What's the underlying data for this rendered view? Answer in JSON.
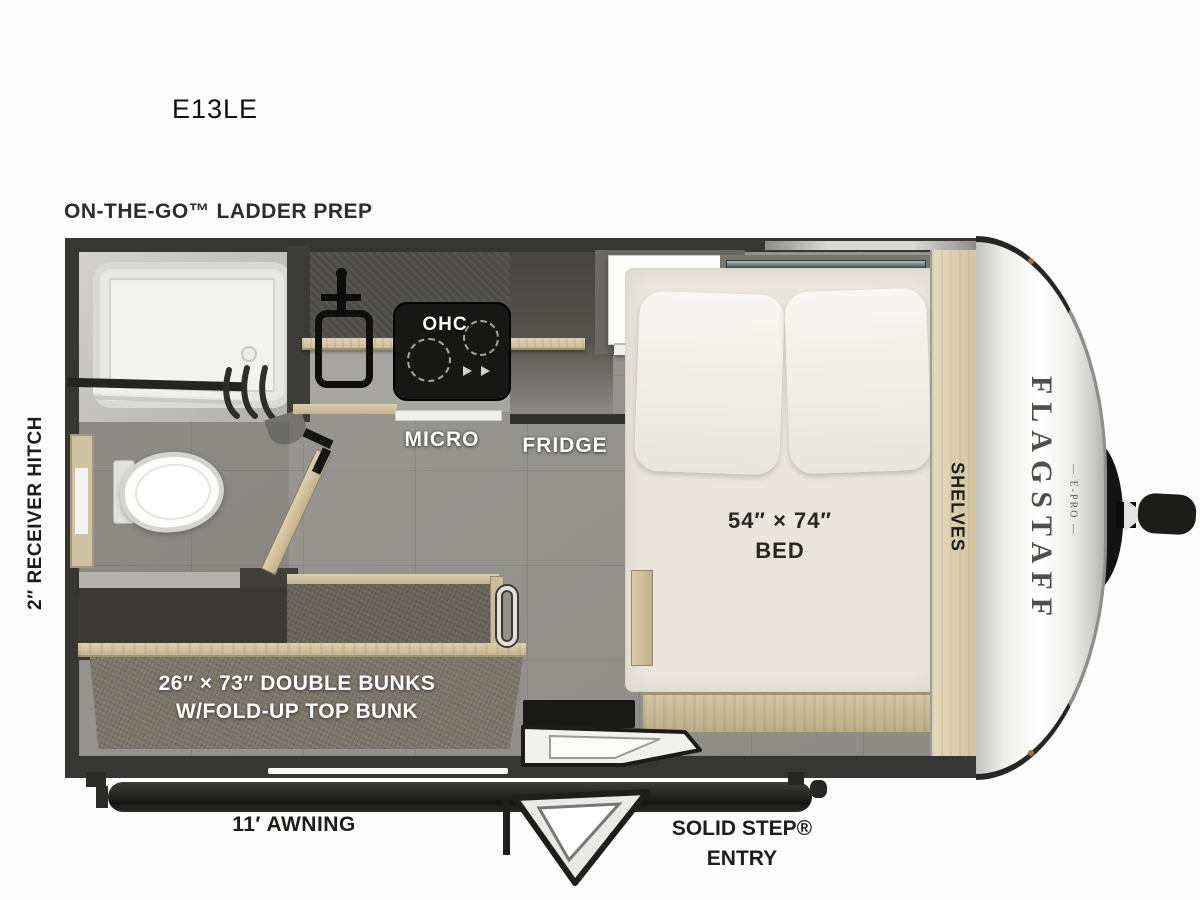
{
  "title": {
    "model": "E13LE"
  },
  "exterior_labels": {
    "ladder_prep": "ON-THE-GO™ LADDER PREP",
    "receiver_hitch": "2″ RECEIVER HITCH",
    "awning": "11′ AWNING",
    "solid_step": "SOLID STEP®",
    "entry": "ENTRY"
  },
  "interior_labels": {
    "ohc": "OHC",
    "micro": "MICRO",
    "fridge": "FRIDGE",
    "ac": "A/C",
    "bed_size": "54″ × 74″",
    "bed": "BED",
    "shelves": "SHELVES",
    "bunks_size": "26″ × 73″ DOUBLE BUNKS",
    "bunks_note": "W/FOLD-UP TOP BUNK"
  },
  "branding": {
    "name": "FLAGSTAFF",
    "series": "— E-PRO —"
  },
  "colors": {
    "wall": "#363634",
    "floor": "#96948f",
    "wood": "#d7c8a6",
    "mattress": "#eae6dd",
    "bunk_fabric": "#7c756a",
    "front_cap": "#f5f5f4",
    "label_white": "#ffffff",
    "label_dark": "#1e1e1c"
  }
}
